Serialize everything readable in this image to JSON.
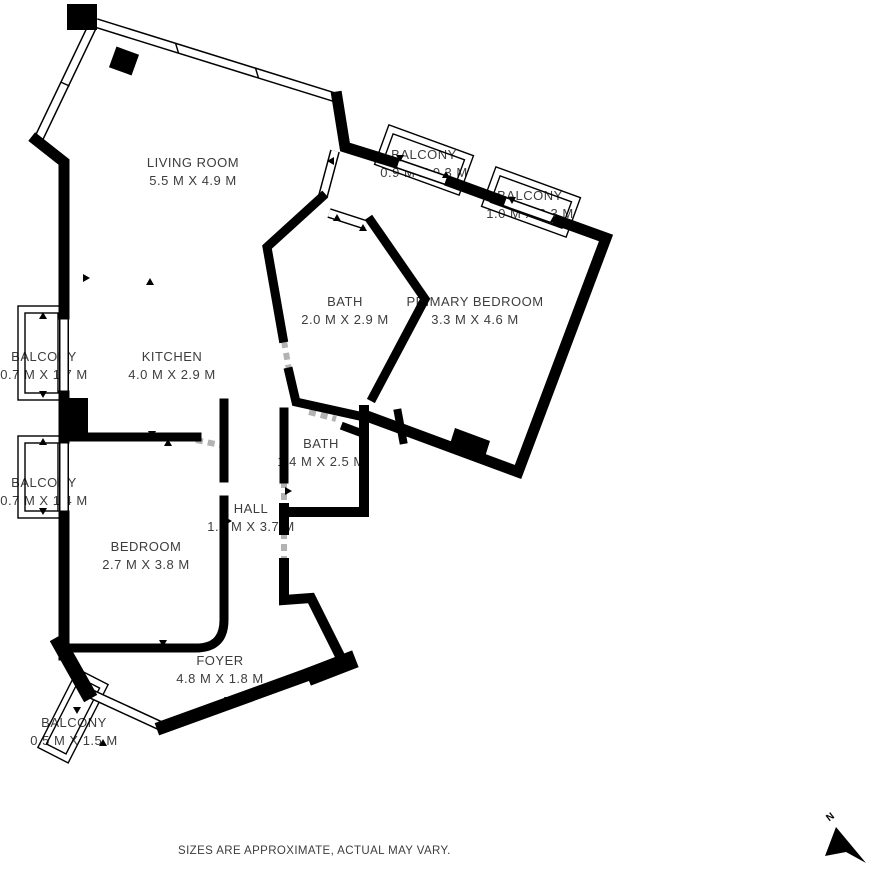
{
  "plan": {
    "rooms": [
      {
        "id": "living-room",
        "name": "LIVING ROOM",
        "dims": "5.5 M X 4.9 M"
      },
      {
        "id": "balcony-top-1",
        "name": "BALCONY",
        "dims": "0.9 M X 0.3 M"
      },
      {
        "id": "balcony-top-2",
        "name": "BALCONY",
        "dims": "1.0 M X 0.3 M"
      },
      {
        "id": "bath-1",
        "name": "BATH",
        "dims": "2.0 M X 2.9 M"
      },
      {
        "id": "primary-bedroom",
        "name": "PRIMARY BEDROOM",
        "dims": "3.3 M X 4.6 M"
      },
      {
        "id": "kitchen",
        "name": "KITCHEN",
        "dims": "4.0 M X 2.9 M"
      },
      {
        "id": "balcony-left-1",
        "name": "BALCONY",
        "dims": "0.7 M X 1.7 M"
      },
      {
        "id": "bath-2",
        "name": "BATH",
        "dims": "1.4 M X 2.5 M"
      },
      {
        "id": "balcony-left-2",
        "name": "BALCONY",
        "dims": "0.7 M X 1.4 M"
      },
      {
        "id": "hall",
        "name": "HALL",
        "dims": "1.1 M X 3.7 M"
      },
      {
        "id": "bedroom",
        "name": "BEDROOM",
        "dims": "2.7 M X 3.8 M"
      },
      {
        "id": "foyer",
        "name": "FOYER",
        "dims": "4.8 M X 1.8 M"
      },
      {
        "id": "balcony-bottom",
        "name": "BALCONY",
        "dims": "0.5 M X 1.5 M"
      }
    ],
    "disclaimer": "SIZES ARE APPROXIMATE, ACTUAL MAY VARY.",
    "north_label": "N",
    "colors": {
      "wall": "#000000",
      "background": "#ffffff",
      "text": "#3d3d3d"
    }
  }
}
